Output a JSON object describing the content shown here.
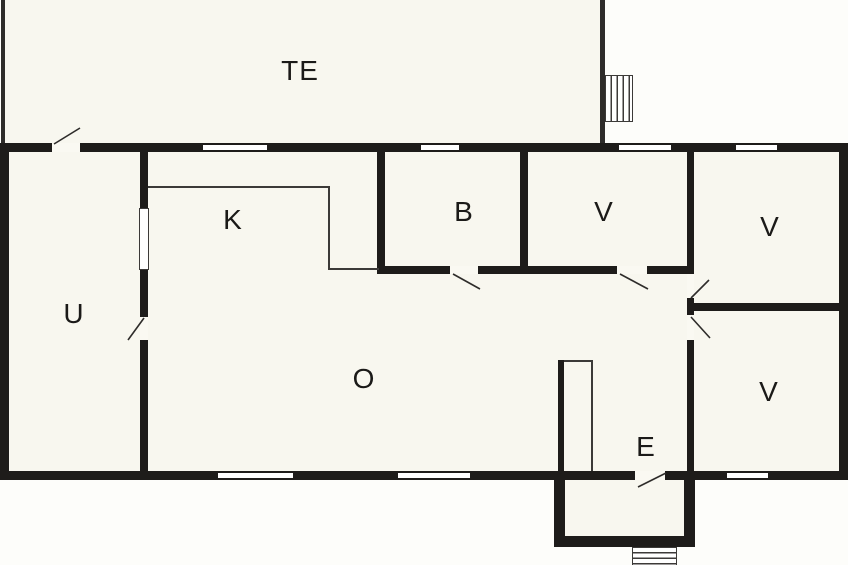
{
  "plan": {
    "kind": "house-floor-plan",
    "rooms": [
      {
        "label": "TE"
      },
      {
        "label": "K"
      },
      {
        "label": "B"
      },
      {
        "label": "V"
      },
      {
        "label": "V"
      },
      {
        "label": "V"
      },
      {
        "label": "U"
      },
      {
        "label": "O"
      },
      {
        "label": "E"
      }
    ],
    "colors": {
      "wall": "#1e1c1a",
      "room_fill": "#f8f7ef",
      "background": "#fdfdfa",
      "detail_line": "#3c3a38"
    }
  }
}
